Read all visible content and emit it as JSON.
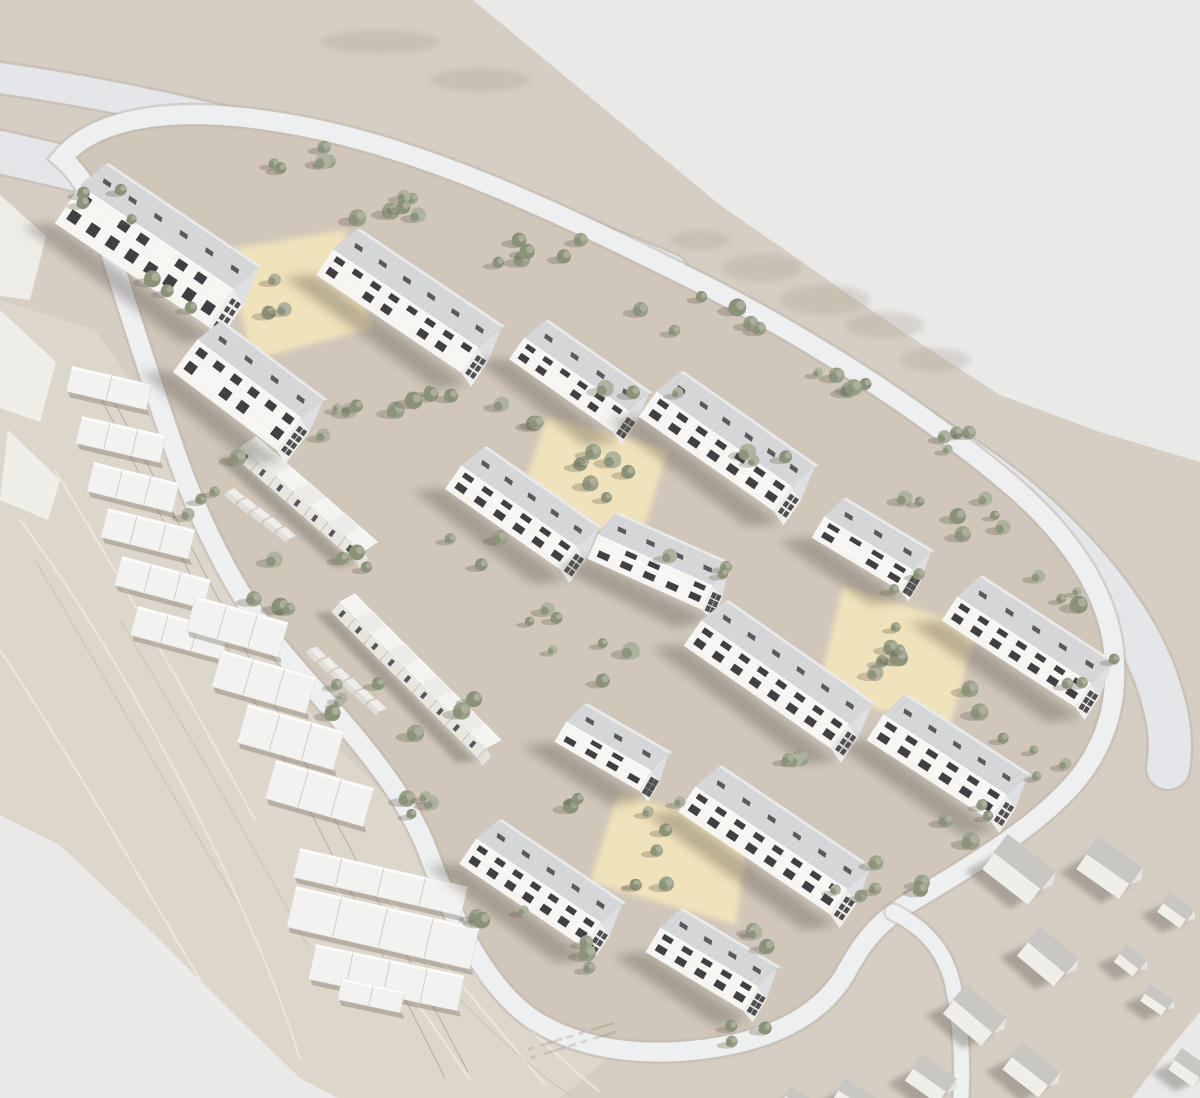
{
  "scene": {
    "kind": "architectural-masterplan-aerial-render",
    "width": 1200,
    "height": 1098
  },
  "colors": {
    "bg": "#e9e9e8",
    "terrain": "#d6cec3",
    "site": "#d0c7ba",
    "marble": "#ddd6ca",
    "road": "#e4e6ea",
    "ring": "#edeff1",
    "casing": "#bdb4a6",
    "court": "#f3e5ba",
    "facade": "#f6f5f2",
    "roof": "#d5d7d9",
    "roofTop": "#e7e9eb",
    "gable": "#eeedea",
    "gableRoof": "#dddfe2",
    "win": "#323236",
    "sky": "#3c3e43",
    "rowFace": "#e8e6e1",
    "rowRoofA": "#f4f4f2",
    "rowRoofB": "#ebebe8",
    "houseBody": "#f0eee9",
    "houseRoof": "#c9c7c4",
    "plate": "#f2f2f1",
    "tree1": "#99a089",
    "tree2": "#8a9278",
    "tree3": "#aeb39f",
    "shadow": "rgba(100,92,78,0.38)",
    "treeShadow": "rgba(92,86,72,0.28)"
  },
  "terrain": {
    "outline": [
      [
        0,
        0
      ],
      [
        473,
        0
      ],
      [
        720,
        205
      ],
      [
        900,
        330
      ],
      [
        1000,
        395
      ],
      [
        1100,
        432
      ],
      [
        1200,
        462
      ],
      [
        1200,
        1012
      ],
      [
        1162,
        1058
      ],
      [
        1132,
        1098
      ],
      [
        338,
        1098
      ],
      [
        300,
        1078
      ],
      [
        240,
        1020
      ],
      [
        150,
        930
      ],
      [
        60,
        845
      ],
      [
        0,
        815
      ]
    ],
    "marble": [
      [
        0,
        300
      ],
      [
        95,
        330
      ],
      [
        160,
        420
      ],
      [
        205,
        540
      ],
      [
        260,
        640
      ],
      [
        330,
        740
      ],
      [
        400,
        810
      ],
      [
        432,
        852
      ],
      [
        470,
        930
      ],
      [
        540,
        1008
      ],
      [
        618,
        1050
      ],
      [
        560,
        1098
      ],
      [
        338,
        1098
      ],
      [
        300,
        1078
      ],
      [
        240,
        1020
      ],
      [
        150,
        930
      ],
      [
        60,
        845
      ],
      [
        0,
        815
      ]
    ],
    "veinsLight": [
      "M 20,520 C 80,600 140,700 200,820 C 240,900 280,990 300,1060",
      "M 55,470 C 115,570 185,690 255,820",
      "M 0,650 C 60,740 130,860 200,980",
      "M 330,880 C 380,950 430,1020 470,1080",
      "M 390,900 C 440,960 500,1030 545,1085",
      "M 450,950 C 500,1000 560,1060 600,1092"
    ],
    "veinsDark": [
      "M 35,560 C 95,660 165,780 235,900",
      "M 420,960 C 470,1010 530,1070 570,1095",
      "M 120,620 C 180,720 250,840 310,950"
    ],
    "contours": [
      [
        88,
        372,
        445,
        1078
      ],
      [
        104,
        382,
        468,
        1072
      ]
    ],
    "blotches": [
      [
        762,
        268,
        40,
        14
      ],
      [
        825,
        300,
        45,
        15
      ],
      [
        885,
        325,
        40,
        13
      ],
      [
        935,
        360,
        35,
        12
      ],
      [
        700,
        240,
        30,
        10
      ],
      [
        380,
        42,
        60,
        12
      ],
      [
        480,
        80,
        50,
        12
      ]
    ],
    "nwWalls": [
      [
        [
          0,
          195
        ],
        [
          46,
          236
        ],
        [
          30,
          300
        ],
        [
          0,
          296
        ]
      ],
      [
        [
          0,
          310
        ],
        [
          56,
          362
        ],
        [
          40,
          422
        ],
        [
          0,
          408
        ]
      ],
      [
        [
          8,
          430
        ],
        [
          60,
          480
        ],
        [
          48,
          520
        ],
        [
          0,
          500
        ]
      ]
    ]
  },
  "roads": {
    "highwayUpper": {
      "d": "M 0,78 C 170,102 340,148 505,205 C 575,230 630,252 672,270",
      "w": 30
    },
    "highwayLower": {
      "d": "M 0,152 C 190,196 400,245 600,300 C 780,350 930,425 1020,500 C 1095,565 1142,630 1160,690 C 1170,722 1172,745 1168,768",
      "w": 42
    },
    "ring": {
      "d": "M 62,158 C 95,118 175,102 300,126 C 430,150 565,216 690,278 C 812,338 922,412 1000,476 C 1064,528 1105,586 1113,646 C 1120,700 1106,742 1080,776 C 1044,822 974,864 914,900 C 876,922 860,946 844,976 C 820,1014 778,1036 724,1046 C 658,1058 588,1054 534,1020 C 488,990 454,922 428,852 C 402,782 338,718 284,654 C 234,594 198,518 174,448 C 150,378 118,278 103,228 C 93,194 78,172 62,158 Z",
      "w": 19
    },
    "spurSouth": {
      "d": "M 893,912 C 925,928 945,950 953,985 C 961,1025 963,1062 961,1098",
      "w": 15
    }
  },
  "courtyards": [
    [
      [
        226,
        250
      ],
      [
        344,
        230
      ],
      [
        372,
        328
      ],
      [
        252,
        360
      ]
    ],
    [
      [
        548,
        416
      ],
      [
        668,
        450
      ],
      [
        640,
        542
      ],
      [
        518,
        500
      ]
    ],
    [
      [
        843,
        586
      ],
      [
        977,
        628
      ],
      [
        948,
        733
      ],
      [
        818,
        690
      ]
    ],
    [
      [
        618,
        793
      ],
      [
        748,
        830
      ],
      [
        736,
        925
      ],
      [
        590,
        882
      ]
    ]
  ],
  "buildings": [
    [
      80,
      186,
      34,
      185,
      45,
      32,
      17,
      4
    ],
    [
      333,
      250,
      34,
      175,
      30,
      30,
      16,
      3
    ],
    [
      524,
      338,
      35,
      127,
      26,
      26,
      14,
      3
    ],
    [
      197,
      340,
      37,
      130,
      40,
      28,
      15,
      4
    ],
    [
      656,
      392,
      35,
      165,
      30,
      30,
      16,
      3
    ],
    [
      461,
      466,
      35,
      141,
      28,
      28,
      15,
      3
    ],
    [
      824,
      517,
      31,
      103,
      24,
      25,
      13,
      3
    ],
    [
      598,
      535,
      24,
      125,
      26,
      26,
      14,
      3
    ],
    [
      957,
      597,
      33,
      159,
      28,
      29,
      15,
      3
    ],
    [
      701,
      621,
      35,
      180,
      30,
      30,
      16,
      3
    ],
    [
      883,
      715,
      33,
      147,
      30,
      28,
      15,
      3
    ],
    [
      566,
      722,
      30,
      98,
      23,
      24,
      13,
      3
    ],
    [
      695,
      787,
      34,
      183,
      30,
      30,
      16,
      3
    ],
    [
      476,
      839,
      34,
      150,
      30,
      28,
      15,
      3
    ],
    [
      660,
      928,
      31,
      114,
      28,
      26,
      14,
      3
    ]
  ],
  "rowhouses": [
    {
      "x": 242,
      "y": 446,
      "a": 37,
      "units": 7,
      "u": 23
    },
    {
      "x": 340,
      "y": 602,
      "a": 41,
      "units": 9,
      "u": 23
    }
  ],
  "sheds": [
    {
      "x": 228,
      "y": 490,
      "a": 37,
      "units": 5,
      "u": 16
    },
    {
      "x": 310,
      "y": 648,
      "a": 41,
      "units": 6,
      "u": 16
    }
  ],
  "terraces": [
    [
      72,
      366,
      82,
      26,
      13
    ],
    [
      82,
      416,
      86,
      28,
      13
    ],
    [
      94,
      462,
      88,
      30,
      14
    ],
    [
      108,
      508,
      90,
      30,
      14
    ],
    [
      122,
      556,
      92,
      30,
      15
    ],
    [
      138,
      606,
      94,
      30,
      15
    ],
    [
      196,
      596,
      96,
      36,
      16
    ],
    [
      222,
      650,
      98,
      38,
      16
    ],
    [
      248,
      704,
      100,
      40,
      16
    ],
    [
      276,
      760,
      102,
      40,
      16
    ],
    [
      300,
      848,
      172,
      30,
      13
    ],
    [
      296,
      886,
      188,
      42,
      13
    ],
    [
      316,
      944,
      152,
      36,
      12
    ],
    [
      342,
      978,
      64,
      22,
      12
    ]
  ],
  "houses": [
    [
      1008,
      836,
      58,
      42,
      38
    ],
    [
      1098,
      838,
      52,
      38,
      35
    ],
    [
      1040,
      928,
      48,
      36,
      40
    ],
    [
      1126,
      946,
      24,
      20,
      38
    ],
    [
      1150,
      986,
      26,
      18,
      34
    ],
    [
      966,
      986,
      50,
      36,
      40
    ],
    [
      1022,
      1044,
      46,
      32,
      38
    ],
    [
      922,
      1056,
      40,
      30,
      35
    ],
    [
      845,
      1080,
      34,
      24,
      32
    ],
    [
      1170,
      894,
      28,
      22,
      36
    ],
    [
      1182,
      1050,
      30,
      24,
      35
    ],
    [
      790,
      1088,
      26,
      18,
      30
    ]
  ],
  "treeClusters": [
    [
      300,
      162,
      55,
      16,
      5
    ],
    [
      418,
      200,
      65,
      18,
      6
    ],
    [
      556,
      252,
      70,
      20,
      6
    ],
    [
      698,
      312,
      70,
      20,
      6
    ],
    [
      828,
      378,
      60,
      18,
      5
    ],
    [
      928,
      438,
      45,
      16,
      4
    ],
    [
      998,
      516,
      38,
      22,
      4
    ],
    [
      1058,
      598,
      34,
      22,
      4
    ],
    [
      1088,
      678,
      28,
      20,
      3
    ],
    [
      1030,
      760,
      38,
      22,
      4
    ],
    [
      950,
      824,
      42,
      22,
      4
    ],
    [
      905,
      874,
      30,
      20,
      3
    ],
    [
      118,
      198,
      38,
      26,
      4
    ],
    [
      168,
      296,
      28,
      22,
      3
    ],
    [
      292,
      300,
      32,
      24,
      3
    ],
    [
      355,
      418,
      38,
      28,
      4
    ],
    [
      420,
      378,
      52,
      34,
      5
    ],
    [
      518,
      428,
      38,
      26,
      3
    ],
    [
      610,
      478,
      46,
      30,
      4
    ],
    [
      643,
      382,
      38,
      22,
      3
    ],
    [
      760,
      458,
      34,
      22,
      3
    ],
    [
      598,
      468,
      36,
      26,
      3
    ],
    [
      898,
      652,
      42,
      26,
      4
    ],
    [
      658,
      860,
      42,
      26,
      4
    ],
    [
      518,
      618,
      44,
      32,
      4
    ],
    [
      600,
      658,
      36,
      24,
      3
    ],
    [
      452,
      718,
      38,
      28,
      3
    ],
    [
      700,
      558,
      36,
      24,
      3
    ],
    [
      872,
      658,
      34,
      24,
      3
    ],
    [
      790,
      738,
      32,
      24,
      3
    ],
    [
      682,
      818,
      34,
      24,
      3
    ],
    [
      215,
      482,
      28,
      34,
      4
    ],
    [
      272,
      588,
      28,
      36,
      4
    ],
    [
      348,
      698,
      32,
      40,
      5
    ],
    [
      428,
      808,
      30,
      34,
      4
    ],
    [
      498,
      898,
      30,
      30,
      3
    ],
    [
      600,
      948,
      34,
      22,
      3
    ],
    [
      762,
      948,
      34,
      20,
      3
    ],
    [
      852,
      898,
      30,
      20,
      3
    ],
    [
      560,
      798,
      26,
      20,
      2
    ],
    [
      900,
      578,
      26,
      18,
      2
    ],
    [
      986,
      698,
      26,
      18,
      2
    ],
    [
      742,
      1032,
      26,
      14,
      3
    ],
    [
      362,
      560,
      30,
      26,
      3
    ],
    [
      476,
      556,
      30,
      24,
      3
    ],
    [
      930,
      508,
      30,
      16,
      3
    ]
  ],
  "roadMarks": {
    "x": 528,
    "y": 1048,
    "rot": -17,
    "rows": 2,
    "dashes": 7
  }
}
